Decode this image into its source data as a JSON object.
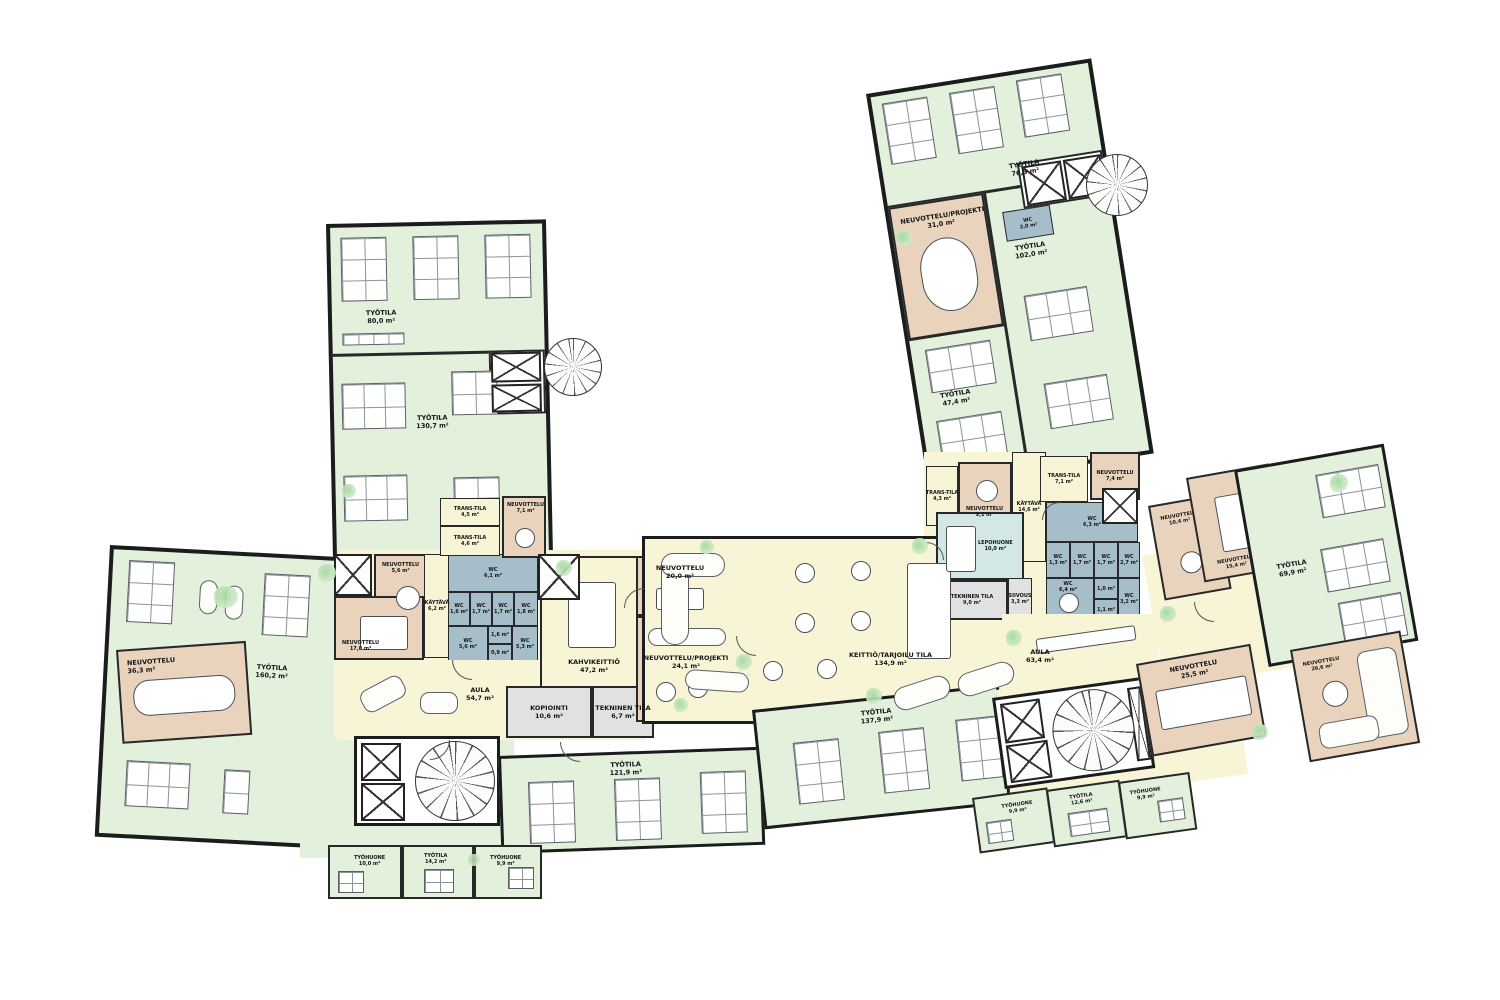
{
  "plan_type": "office-floor-plan",
  "palette": {
    "workspace_green": "#e3f0dc",
    "circulation_yellow": "#f8f5d6",
    "meeting_tan": "#e9d3bd",
    "wc_bluegray": "#a6bec9",
    "rest_blue": "#d3e7e6",
    "service_gray": "#e1e1e1",
    "wall_black": "#1a1c1e",
    "plant_green": "#a4d69e"
  },
  "rooms": {
    "nw_tyotila_80": {
      "name": "TYÖTILA",
      "area": "80,0 m²"
    },
    "nw_tyotila_130": {
      "name": "TYÖTILA",
      "area": "130,7 m²"
    },
    "nw_trans_45": {
      "name": "TRANS-TILA",
      "area": "4,5 m²"
    },
    "nw_trans_46": {
      "name": "TRANS-TILA",
      "area": "4,6 m²"
    },
    "nw_neu_71": {
      "name": "NEUVOTTELU",
      "area": "7,1 m²"
    },
    "w_neu_56": {
      "name": "NEUVOTTELU",
      "area": "5,6 m²"
    },
    "w_neu_170": {
      "name": "NEUVOTTELU",
      "area": "17,0 m²"
    },
    "w_kaytava_62": {
      "name": "KÄYTÄVÄ",
      "area": "6,2 m²"
    },
    "w_wc_61": {
      "name": "WC",
      "area": "6,1 m²"
    },
    "w_wc_16a": {
      "name": "WC",
      "area": "1,6 m²"
    },
    "w_wc_17a": {
      "name": "WC",
      "area": "1,7 m²"
    },
    "w_wc_17b": {
      "name": "WC",
      "area": "1,7 m²"
    },
    "w_wc_18": {
      "name": "WC",
      "area": "1,8 m²"
    },
    "w_wc_56": {
      "name": "WC",
      "area": "5,6 m²"
    },
    "w_wc_16b": {
      "name": "WC",
      "area": "1,6 m²"
    },
    "w_wc_09": {
      "name": "WC",
      "area": "0,9 m²"
    },
    "w_wc_53": {
      "name": "WC",
      "area": "5,3 m²"
    },
    "w_aula_547": {
      "name": "AULA",
      "area": "54,7 m²"
    },
    "w_neu_363": {
      "name": "NEUVOTTELU",
      "area": "36,3 m²"
    },
    "w_tyotila_160": {
      "name": "TYÖTILA",
      "area": "160,2 m²"
    },
    "w_tyohuone_100": {
      "name": "TYÖHUONE",
      "area": "10,0 m²"
    },
    "w_tyotila_142": {
      "name": "TYÖTILA",
      "area": "14,2 m²"
    },
    "w_tyohuone_99": {
      "name": "TYÖHUONE",
      "area": "9,9 m²"
    },
    "c_kahvikeittio": {
      "name": "KAHVIKEITTIÖ",
      "area": "47,2 m²"
    },
    "c_neu_200": {
      "name": "NEUVOTTELU",
      "area": "20,0 m²"
    },
    "c_neuproj_241": {
      "name": "NEUVOTTELU/PROJEKTI",
      "area": "24,1 m²"
    },
    "c_kopiointi": {
      "name": "KOPIOINTI",
      "area": "10,6 m²"
    },
    "c_tekninen_67": {
      "name": "TEKNINEN TILA",
      "area": "6,7 m²"
    },
    "c_keittio": {
      "name": "KEITTIÖ/TARJOILU TILA",
      "area": "134,9 m²"
    },
    "c_tyotila_121": {
      "name": "TYÖTILA",
      "area": "121,9 m²"
    },
    "c_tyotila_137": {
      "name": "TYÖTILA",
      "area": "137,9 m²"
    },
    "ne_tyotila_76": {
      "name": "TYÖTILA",
      "area": "76,3 m²"
    },
    "ne_neuproj_310": {
      "name": "NEUVOTTELU/PROJEKTI",
      "area": "31,0 m²"
    },
    "ne_wc_20": {
      "name": "WC",
      "area": "2,0 m²"
    },
    "ne_tyotila_102": {
      "name": "TYÖTILA",
      "area": "102,0 m²"
    },
    "ne_tyotila_474": {
      "name": "TYÖTILA",
      "area": "47,4 m²"
    },
    "j_trans_43": {
      "name": "TRANS-TILA",
      "area": "4,3 m²"
    },
    "j_neu_91": {
      "name": "NEUVOTTELU",
      "area": "9,1 m²"
    },
    "j_kaytava_146": {
      "name": "KÄYTÄVÄ",
      "area": "14,6 m²"
    },
    "j_trans_71": {
      "name": "TRANS-TILA",
      "area": "7,1 m²"
    },
    "j_neu_74": {
      "name": "NEUVOTTELU",
      "area": "7,4 m²"
    },
    "j_lepohuone": {
      "name": "LEPOHUONE",
      "area": "10,0 m²"
    },
    "j_tekninen_90": {
      "name": "TEKNINEN TILA",
      "area": "9,0 m²"
    },
    "j_siivous": {
      "name": "SIIVOUS",
      "area": "3,3 m²"
    },
    "j_wc_63": {
      "name": "WC",
      "area": "6,3 m²"
    },
    "j_wc_13": {
      "name": "WC",
      "area": "1,3 m²"
    },
    "j_wc_17a": {
      "name": "WC",
      "area": "1,7 m²"
    },
    "j_wc_17b": {
      "name": "WC",
      "area": "1,7 m²"
    },
    "j_wc_27": {
      "name": "WC",
      "area": "2,7 m²"
    },
    "j_wc_64": {
      "name": "WC",
      "area": "6,4 m²"
    },
    "j_wc_10": {
      "name": "WC",
      "area": "1,0 m²"
    },
    "j_wc_11": {
      "name": "WC",
      "area": "1,1 m²"
    },
    "j_wc_32": {
      "name": "WC",
      "area": "3,2 m²"
    },
    "e_aula_634": {
      "name": "AULA",
      "area": "63,4 m²"
    },
    "e_neu_104": {
      "name": "NEUVOTTELU",
      "area": "10,4 m²"
    },
    "e_neu_154": {
      "name": "NEUVOTTELU",
      "area": "15,4 m²"
    },
    "e_tyotila_699": {
      "name": "TYÖTILA",
      "area": "69,9 m²"
    },
    "e_neu_255": {
      "name": "NEUVOTTELU",
      "area": "25,5 m²"
    },
    "e_kaytava_580": {
      "name": "KÄYTÄVÄ",
      "area": "58,0 m²"
    },
    "e_neu_266": {
      "name": "NEUVOTTELU",
      "area": "26,6 m²"
    },
    "e_tyohuone_99a": {
      "name": "TYÖHUONE",
      "area": "9,9 m²"
    },
    "e_tyotila_126": {
      "name": "TYÖTILA",
      "area": "12,6 m²"
    },
    "e_tyohuone_99b": {
      "name": "TYÖHUONE",
      "area": "9,9 m²"
    }
  }
}
